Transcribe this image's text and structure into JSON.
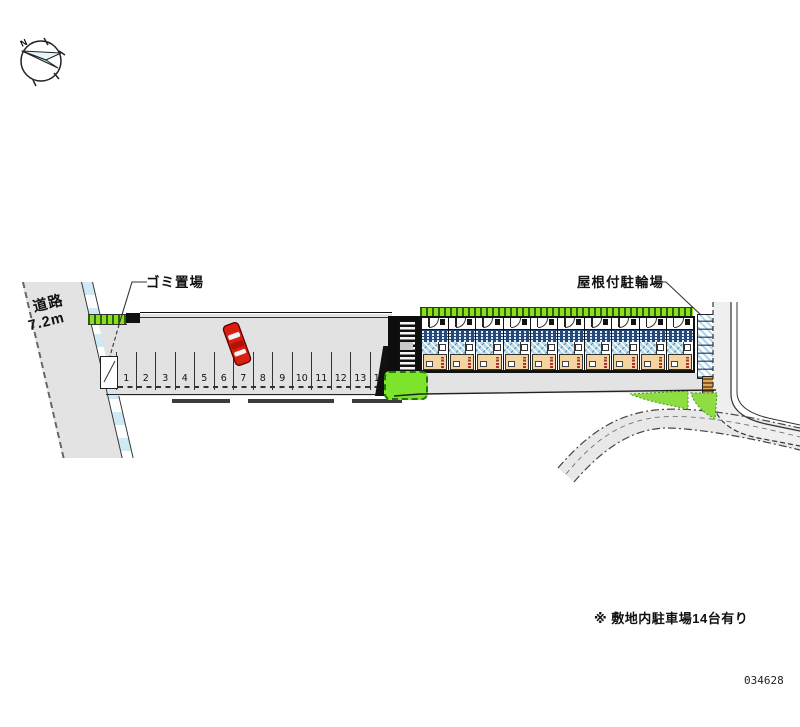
{
  "labels": {
    "road_name": "道路",
    "road_width": "7.2m",
    "garbage_area": "ゴミ置場",
    "covered_bicycle_parking": "屋根付駐輪場",
    "north_mark": "N"
  },
  "parking": {
    "stalls": [
      "1",
      "2",
      "3",
      "4",
      "5",
      "6",
      "7",
      "8",
      "9",
      "10",
      "11",
      "12",
      "13",
      "14"
    ]
  },
  "building": {
    "unit_count": 10
  },
  "footer": {
    "note": "※ 敷地内駐車場14台有り",
    "plan_number": "034628"
  },
  "colors": {
    "road_gray": "#e3e3e3",
    "parking_gray": "#e2e2e2",
    "sidewalk_blue": "#cfe9f5",
    "hedge_green": "#8fdc1f",
    "bush_green": "#7de32b",
    "patch_green": "#8ede42",
    "building_tan": "#f4d4a0",
    "unit_navy": "#25497a",
    "unit_blue": "#b5dcee",
    "car_red": "#d92010",
    "compass_blue": "#bfe0f0",
    "line_dark": "#111111"
  }
}
